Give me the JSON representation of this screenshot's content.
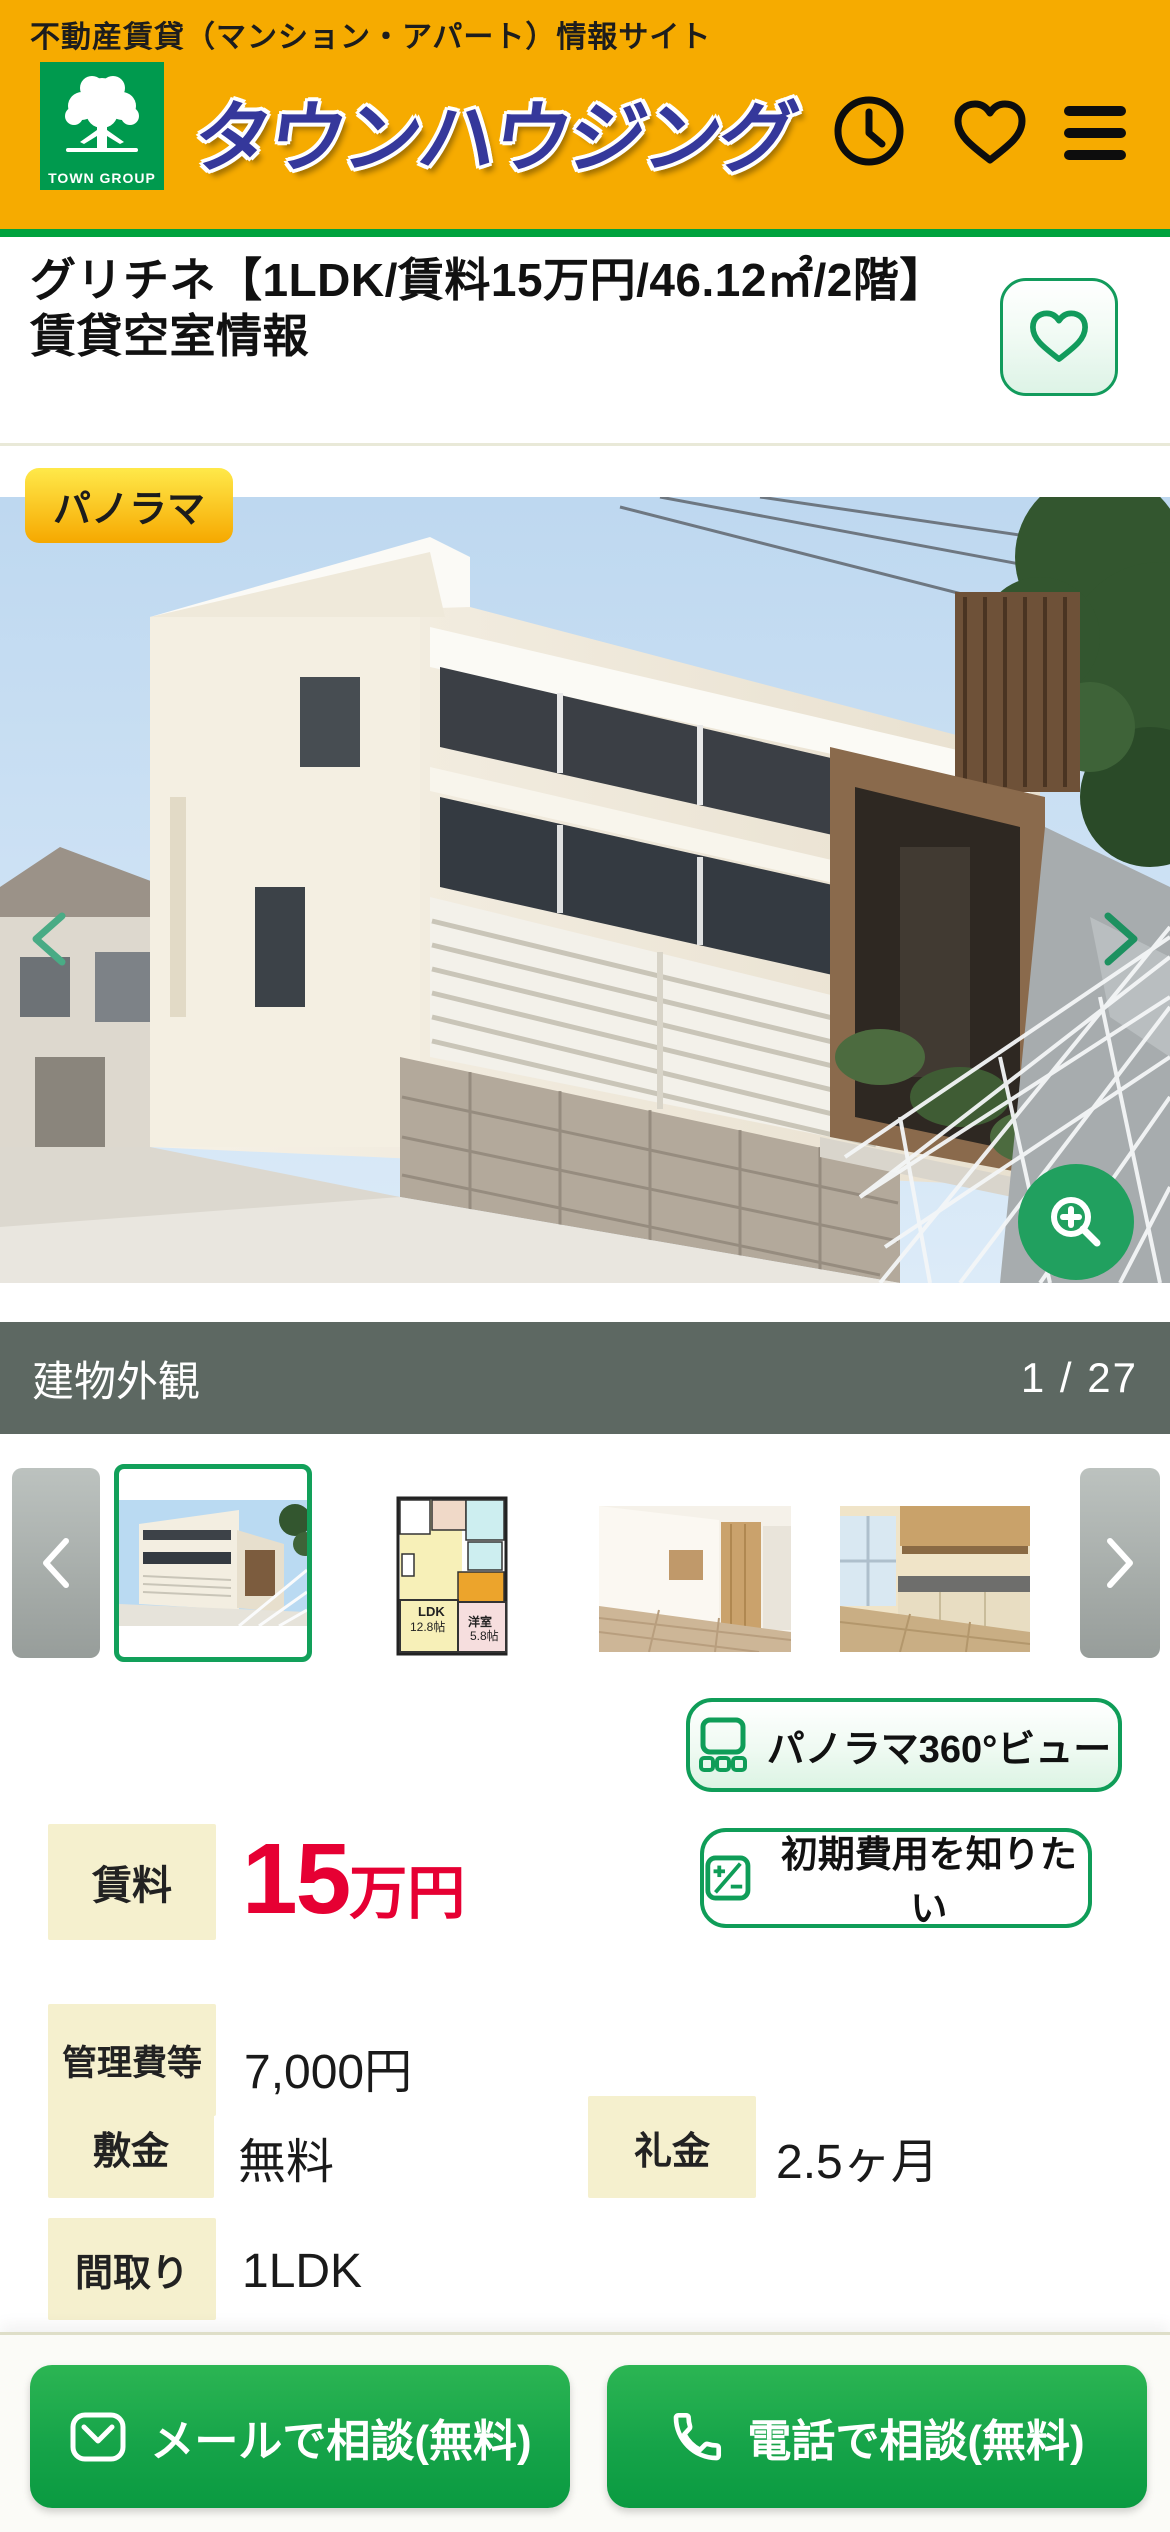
{
  "topbar": {
    "site_description": "不動産賃貸（マンション・アパート）情報サイト"
  },
  "header": {
    "logo_caption": "TOWN GROUP",
    "brand": "タウンハウジング",
    "icons": [
      "clock-icon",
      "heart-icon",
      "hamburger-menu-icon"
    ]
  },
  "listing": {
    "title": "グリチネ【1LDK/賃料15万円/46.12㎡/2階】賃貸空室情報"
  },
  "gallery": {
    "badge": "パノラマ",
    "caption": "建物外観",
    "counter": "1 / 27",
    "icons": [
      "chevron-left-icon",
      "chevron-right-icon",
      "zoom-in-icon"
    ]
  },
  "thumbnails": {
    "floorplan": {
      "ldk_line1": "LDK",
      "ldk_line2": "12.8帖",
      "room_line1": "洋室",
      "room_line2": "5.8帖"
    }
  },
  "actions": {
    "panorama_button": "パノラマ360°ビュー",
    "cost_button": "初期費用を知りたい",
    "mail_button": "メールで相談(無料)",
    "phone_button": "電話で相談(無料)"
  },
  "property": {
    "rent": {
      "label": "賃料",
      "value_main": "15",
      "value_unit": "万円"
    },
    "management_fee": {
      "label": "管理費等",
      "value": "7,000円"
    },
    "deposit": {
      "label": "敷金",
      "value": "無料"
    },
    "key_money": {
      "label": "礼金",
      "value": "2.5ヶ月"
    },
    "layout": {
      "label": "間取り",
      "value": "1LDK"
    }
  },
  "colors": {
    "brand_yellow": "#f6ab00",
    "brand_green": "#009a4e",
    "outline_green": "#0f9d58",
    "header_line_green": "#00a23e",
    "logo_blue": "#35389b",
    "accent_red": "#e60033",
    "caption_bar": "#5d6862",
    "label_bg": "#f5f0ce",
    "cta_green_top": "#2cb553",
    "cta_green_bottom": "#0a9a41",
    "thumb_arrow_gray": "#9aa09d"
  }
}
